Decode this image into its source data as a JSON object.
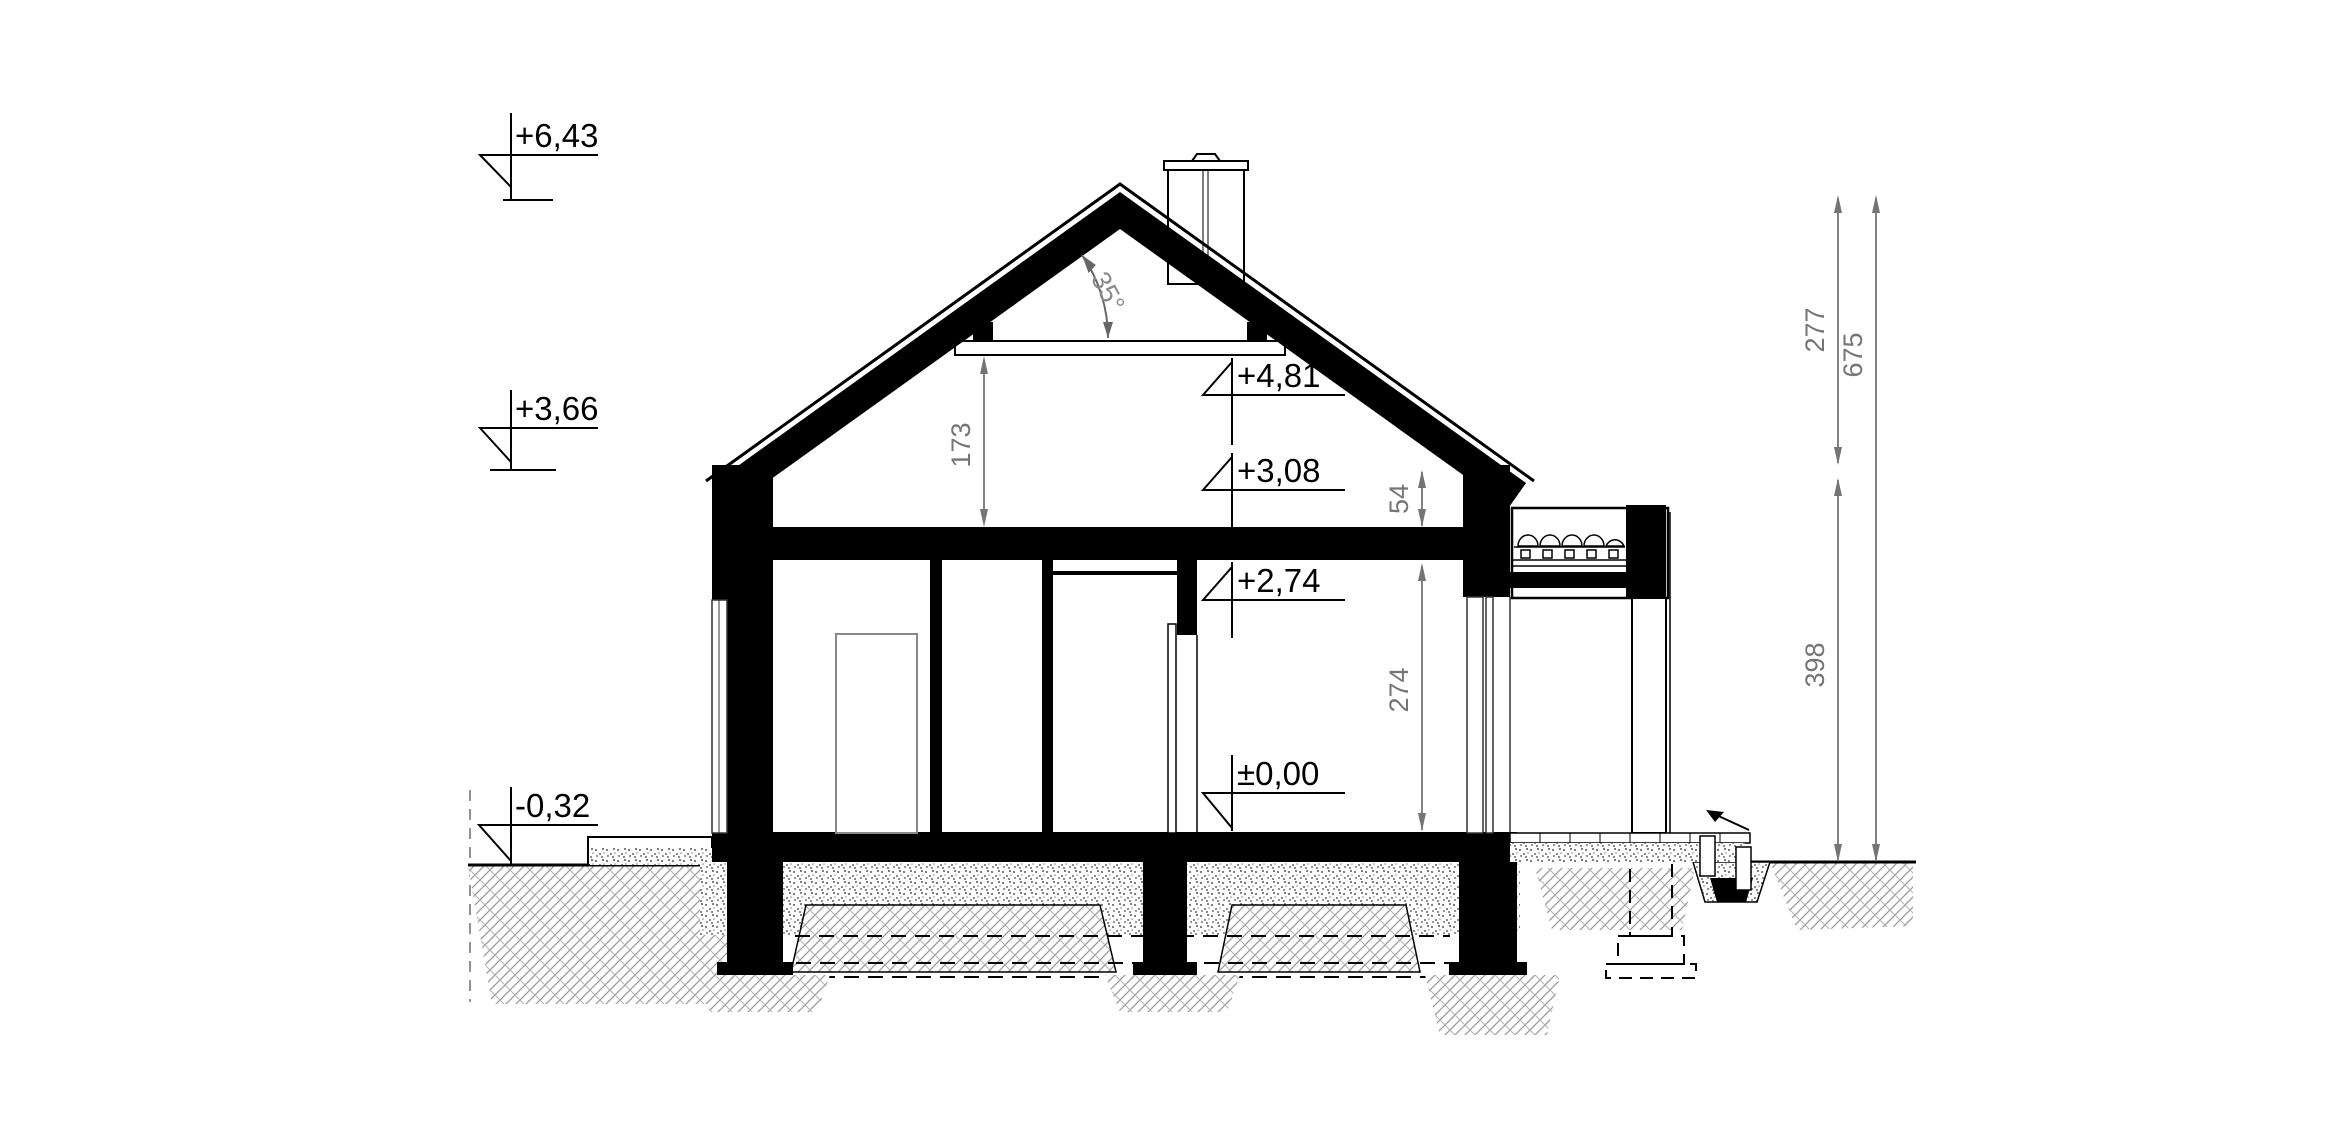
{
  "drawing": {
    "levels": {
      "ridge": "+6,43",
      "eaves": "+3,66",
      "terrain": "-0,32",
      "collar": "+4,81",
      "slab_top": "+3,08",
      "ceiling": "+2,74",
      "floor": "±0,00"
    },
    "dims": {
      "attic_height": "173",
      "knee_height": "54",
      "room_height": "274",
      "roof_height": "277",
      "total_height": "675",
      "wall_height": "398"
    },
    "angles": {
      "roof_pitch": "35°"
    },
    "colors": {
      "ink": "#000000",
      "dim_gray": "#757575",
      "soil_gray": "#a0a0a0"
    }
  }
}
